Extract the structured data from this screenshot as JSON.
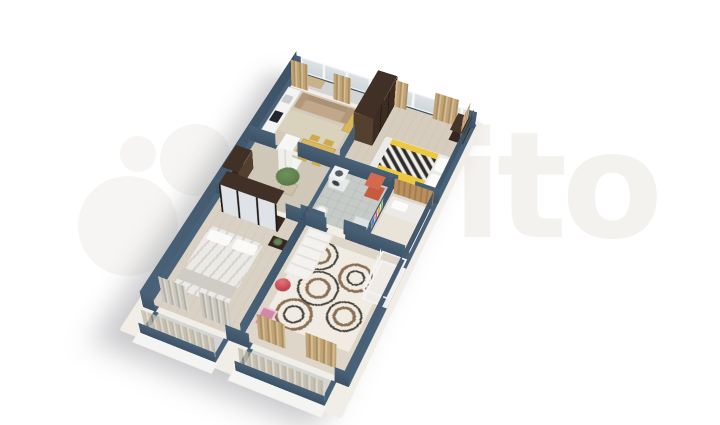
{
  "watermark": {
    "brand": "avito",
    "visible_text": "ito",
    "circles": [
      {
        "name": "large",
        "cx": 128,
        "cy": 226,
        "r": 50
      },
      {
        "name": "medium",
        "cx": 196,
        "cy": 160,
        "r": 36
      },
      {
        "name": "small",
        "cx": 138,
        "cy": 154,
        "r": 18
      },
      {
        "name": "small-medium",
        "cx": 206,
        "cy": 238,
        "r": 22
      }
    ]
  },
  "palette": {
    "wm_text": "#f4f2ef",
    "wm_circle": "#f6f5f3",
    "wall": "#4a6278",
    "wall_dark": "#3d5266",
    "plinth": "#f0eee7",
    "floor_kitchen": "#d3cabb",
    "floor_bedroom": "#d6cdbe",
    "floor_master": "#d9d1c4",
    "floor_kids": "#ddd6c9",
    "floor_hall": "#cfc7b8",
    "floor_tile": "#c6cbc7",
    "floor_loggia": "#d2d5d4",
    "curtain_tan": "#c0a478",
    "curtain_tan_dark": "#aa8e62",
    "wood_dark": "#352720",
    "wood_mid": "#54402f",
    "mirror": "#dfe3e7",
    "yellow": "#ecc93f",
    "white_soft": "#f4f4f2",
    "sofa": "#c2a88a",
    "rug_kitchen": "#d9d3be",
    "table": "#d9b75c",
    "bed_white": "#eceae6",
    "bed_gray": "#cfccc6",
    "red": "#c8484f",
    "orange_red": "#c65b40",
    "pink": "#d08aa6",
    "plant": "#5d7f4c",
    "glass": "#dde3e6",
    "window_frame": "#f6f6f6",
    "rug_base": "#f0ebe3",
    "swirl_brown": "#8a6f52",
    "swirl_dark": "#45403a",
    "headboard_wood": "#b98f5e",
    "crib_white": "#f5f4f2"
  },
  "scene": {
    "type": "isometric-3d-floorplan",
    "style": "cut-wall apartment render, dark slate-blue walls, light wood floors, white facade plinth",
    "rooms": [
      {
        "name": "loggia",
        "furniture": [
          "bench-cushion",
          "glazed-windows",
          "tan-curtains"
        ]
      },
      {
        "name": "kitchen-living-room",
        "furniture": [
          "white-kitchen-counter",
          "sink",
          "black-cooktop",
          "beige-corner-sofa",
          "area-rug",
          "dining-table",
          "four-chairs",
          "tall-white-cabinet",
          "yellow-cabinet"
        ]
      },
      {
        "name": "bedroom-1",
        "furniture": [
          "dark-brown-wardrobe",
          "double-bed-yellow-chevron-bedding",
          "white-pillows",
          "dark-desk",
          "tan-curtains",
          "back-windows"
        ]
      },
      {
        "name": "hallway",
        "furniture": [
          "dark-entry-cabinet",
          "potted-plant"
        ]
      },
      {
        "name": "bathroom",
        "furniture": [
          "washing-machine",
          "toilet",
          "red-shower-cabinet",
          "sink-vanity"
        ]
      },
      {
        "name": "master-bedroom",
        "furniture": [
          "mirrored-dark-wardrobe",
          "double-bed-marble-bedding",
          "dark-nightstand-with-plant",
          "gray-curtains"
        ]
      },
      {
        "name": "kids-room",
        "furniture": [
          "swirl-pattern-rug",
          "white-crib",
          "white-shelf-rack",
          "red-ball",
          "pink-chest",
          "wooden-bed",
          "colorful-wall-shelf",
          "tan-curtains"
        ]
      },
      {
        "name": "balcony-master",
        "furniture": [
          "glazing",
          "sheer-curtains",
          "white-plinth"
        ]
      },
      {
        "name": "balcony-kids",
        "furniture": [
          "glazing",
          "sheer-curtains",
          "white-plinth"
        ]
      }
    ]
  }
}
